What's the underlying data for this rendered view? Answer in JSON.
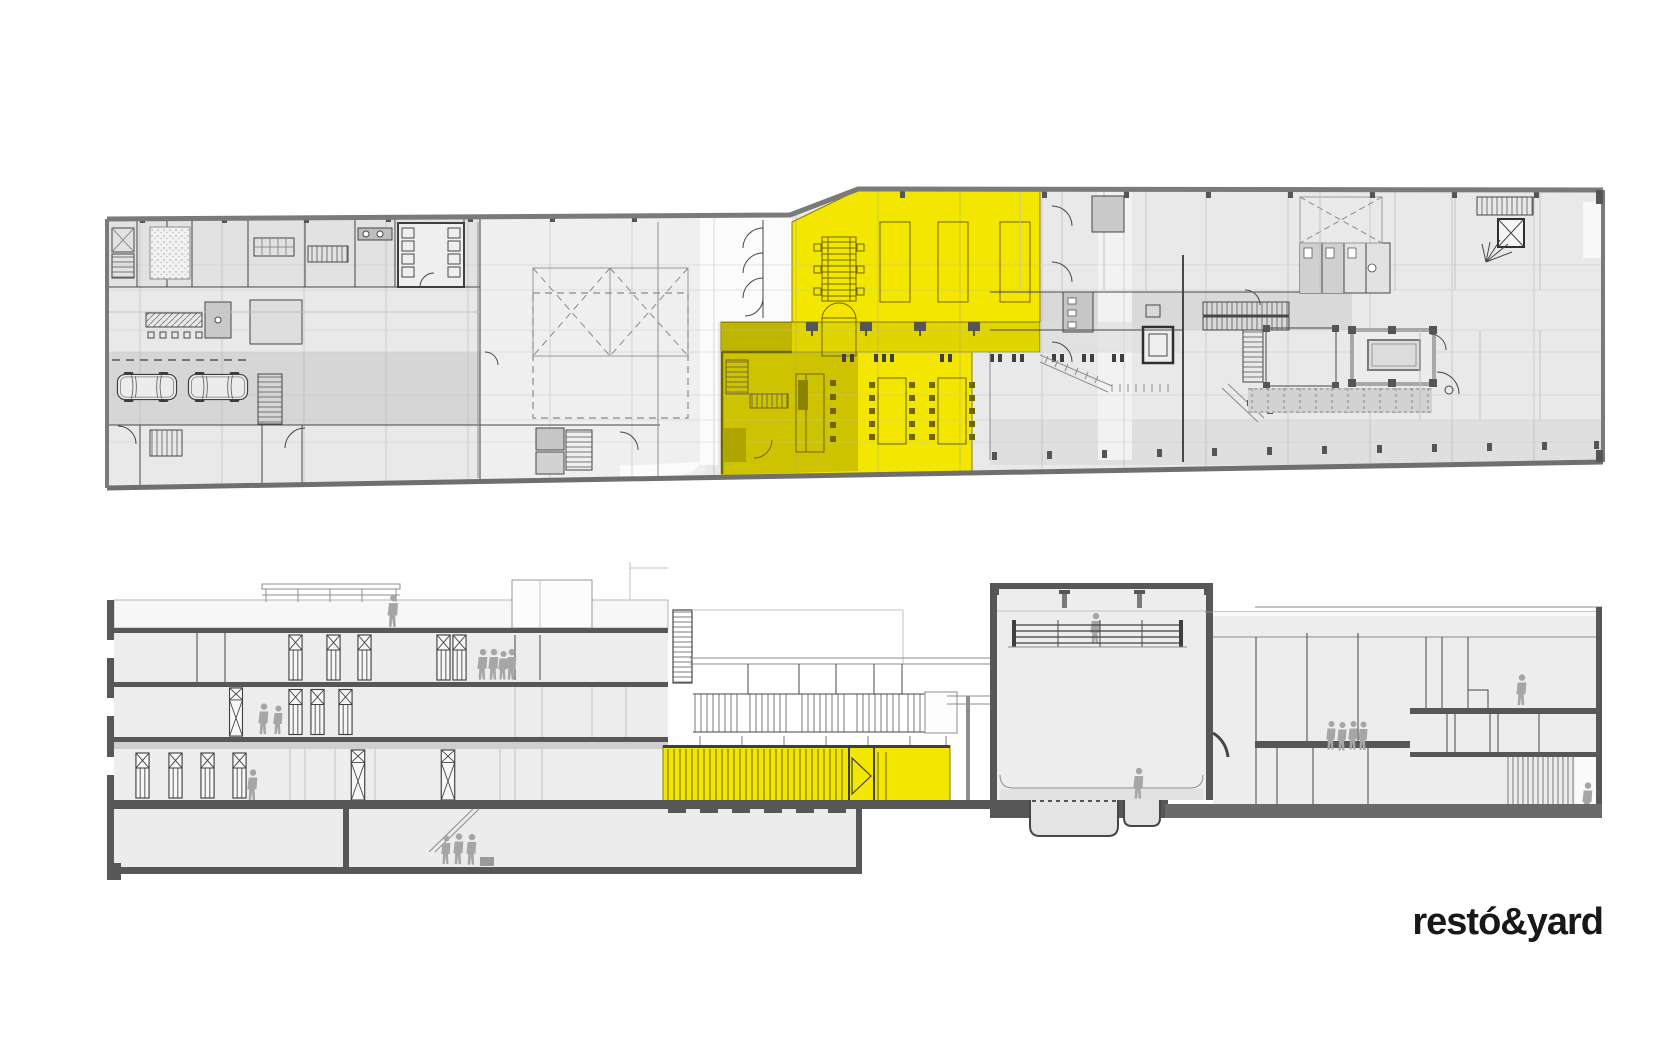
{
  "logo": {
    "text": "restó&yard"
  },
  "colors": {
    "background": "#ffffff",
    "highlight": "#f3e600",
    "highlight_line": "#6f6600",
    "plan_fill": "#e9e9e9",
    "plan_band": "#d6d6d6",
    "section_fill": "#ededed",
    "slab": "#575757",
    "wall": "#474747",
    "figure": "#a6a6a6",
    "logo_color": "#181818"
  }
}
